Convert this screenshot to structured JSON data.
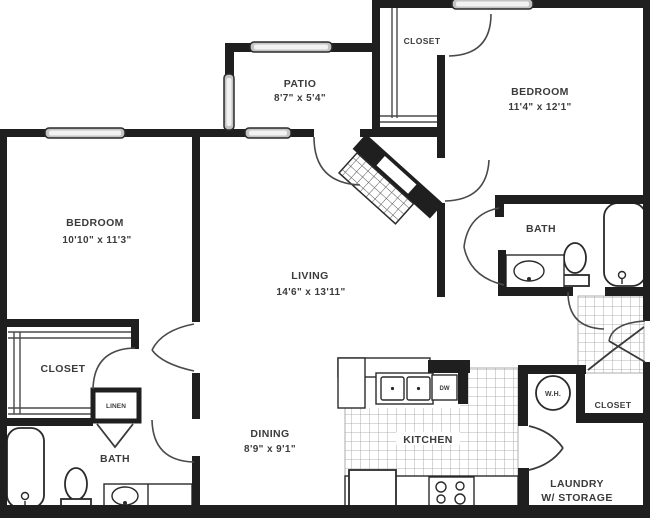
{
  "plan_title": "Two Bedroom Two Bath Floor Plan",
  "rooms": {
    "patio": {
      "label": "PATIO",
      "dims": "8'7\" x 5'4\""
    },
    "closet_top": {
      "label": "CLOSET"
    },
    "bedroom_right": {
      "label": "BEDROOM",
      "dims": "11'4\" x 12'1\""
    },
    "bedroom_left": {
      "label": "BEDROOM",
      "dims": "10'10\" x 11'3\""
    },
    "living": {
      "label": "LIVING",
      "dims": "14'6\" x 13'11\""
    },
    "bath_right": {
      "label": "BATH"
    },
    "closet_left": {
      "label": "CLOSET"
    },
    "linen": {
      "label": "LINEN"
    },
    "bath_left": {
      "label": "BATH"
    },
    "dining": {
      "label": "DINING",
      "dims": "8'9\" x 9'1\""
    },
    "kitchen": {
      "label": "KITCHEN"
    },
    "water_heater": {
      "label": "W.H."
    },
    "closet_entry": {
      "label": "CLOSET"
    },
    "laundry": {
      "label": "LAUNDRY",
      "label2": "W/ STORAGE"
    }
  },
  "appliances": {
    "dishwasher": {
      "label": "DW"
    }
  },
  "colors": {
    "wall": "#1f1f1f",
    "line": "#4a4a4a",
    "window_fill": "#c4c4c4",
    "text": "#3b3b3b",
    "background": "#ffffff"
  }
}
